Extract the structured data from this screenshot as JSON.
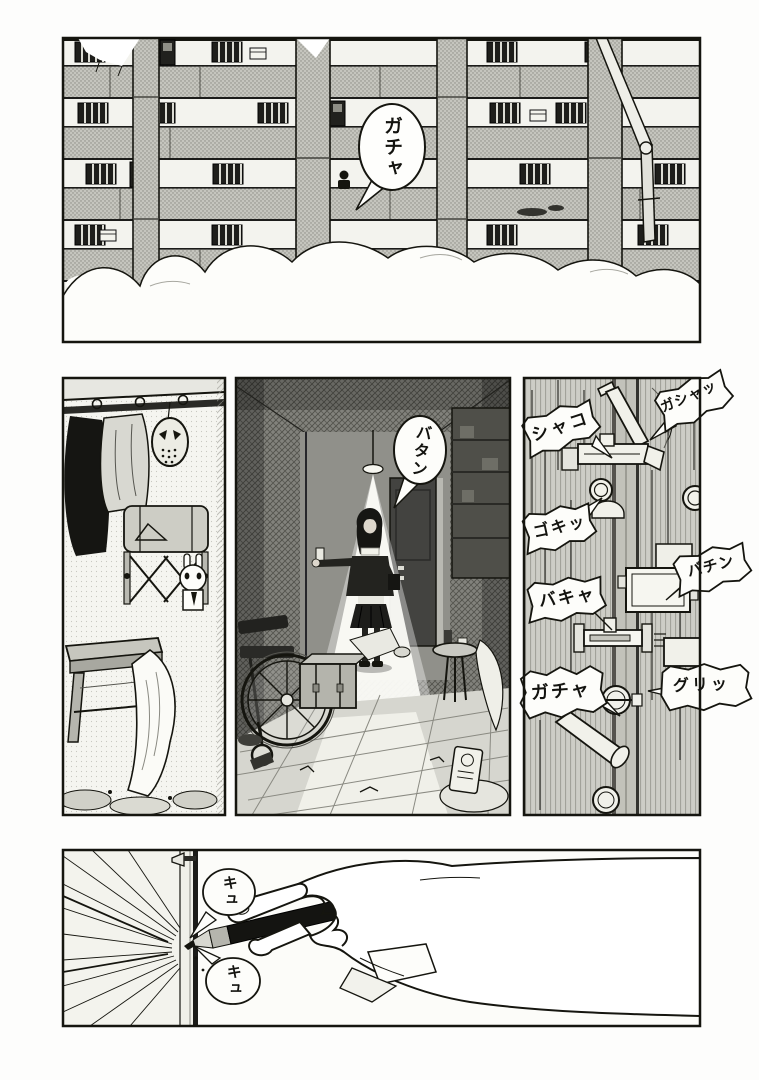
{
  "page": {
    "medium": "manga page",
    "reading_direction": "right-to-left",
    "ink_color": "#15150f",
    "paper_color": "#fdfdfc"
  },
  "panels": [
    {
      "id": "apartment-exterior",
      "description": "Snow-covered apartment building facade with barred windows, balconies and pillars",
      "sfx": [
        {
          "text": "ガチャ"
        }
      ]
    },
    {
      "id": "cluttered-room",
      "description": "Room corner: hanging clothes, hockey mask, backpack on rack, rabbit doll, wooden stool, draped cloth",
      "sfx": []
    },
    {
      "id": "dark-room-light",
      "description": "Girl under a cone of lamplight reaching for a wall switch; wheelchair, trunk and rubble on tiled floor",
      "sfx": [
        {
          "text": "バタン"
        }
      ]
    },
    {
      "id": "door-locks",
      "description": "Close-up of a door edge being secured with many bolts, latches and knobs",
      "sfx": [
        {
          "text": "シャコ"
        },
        {
          "text": "ガシャッ"
        },
        {
          "text": "ゴキッ"
        },
        {
          "text": "バキャ"
        },
        {
          "text": "バチン"
        },
        {
          "text": "ガチャ"
        },
        {
          "text": "グリッ"
        }
      ]
    },
    {
      "id": "hand-marker",
      "description": "Hand writing on a wall post with a black marker, squeak sounds",
      "sfx": [
        {
          "text": "キュ"
        },
        {
          "text": "キュ"
        }
      ]
    }
  ]
}
